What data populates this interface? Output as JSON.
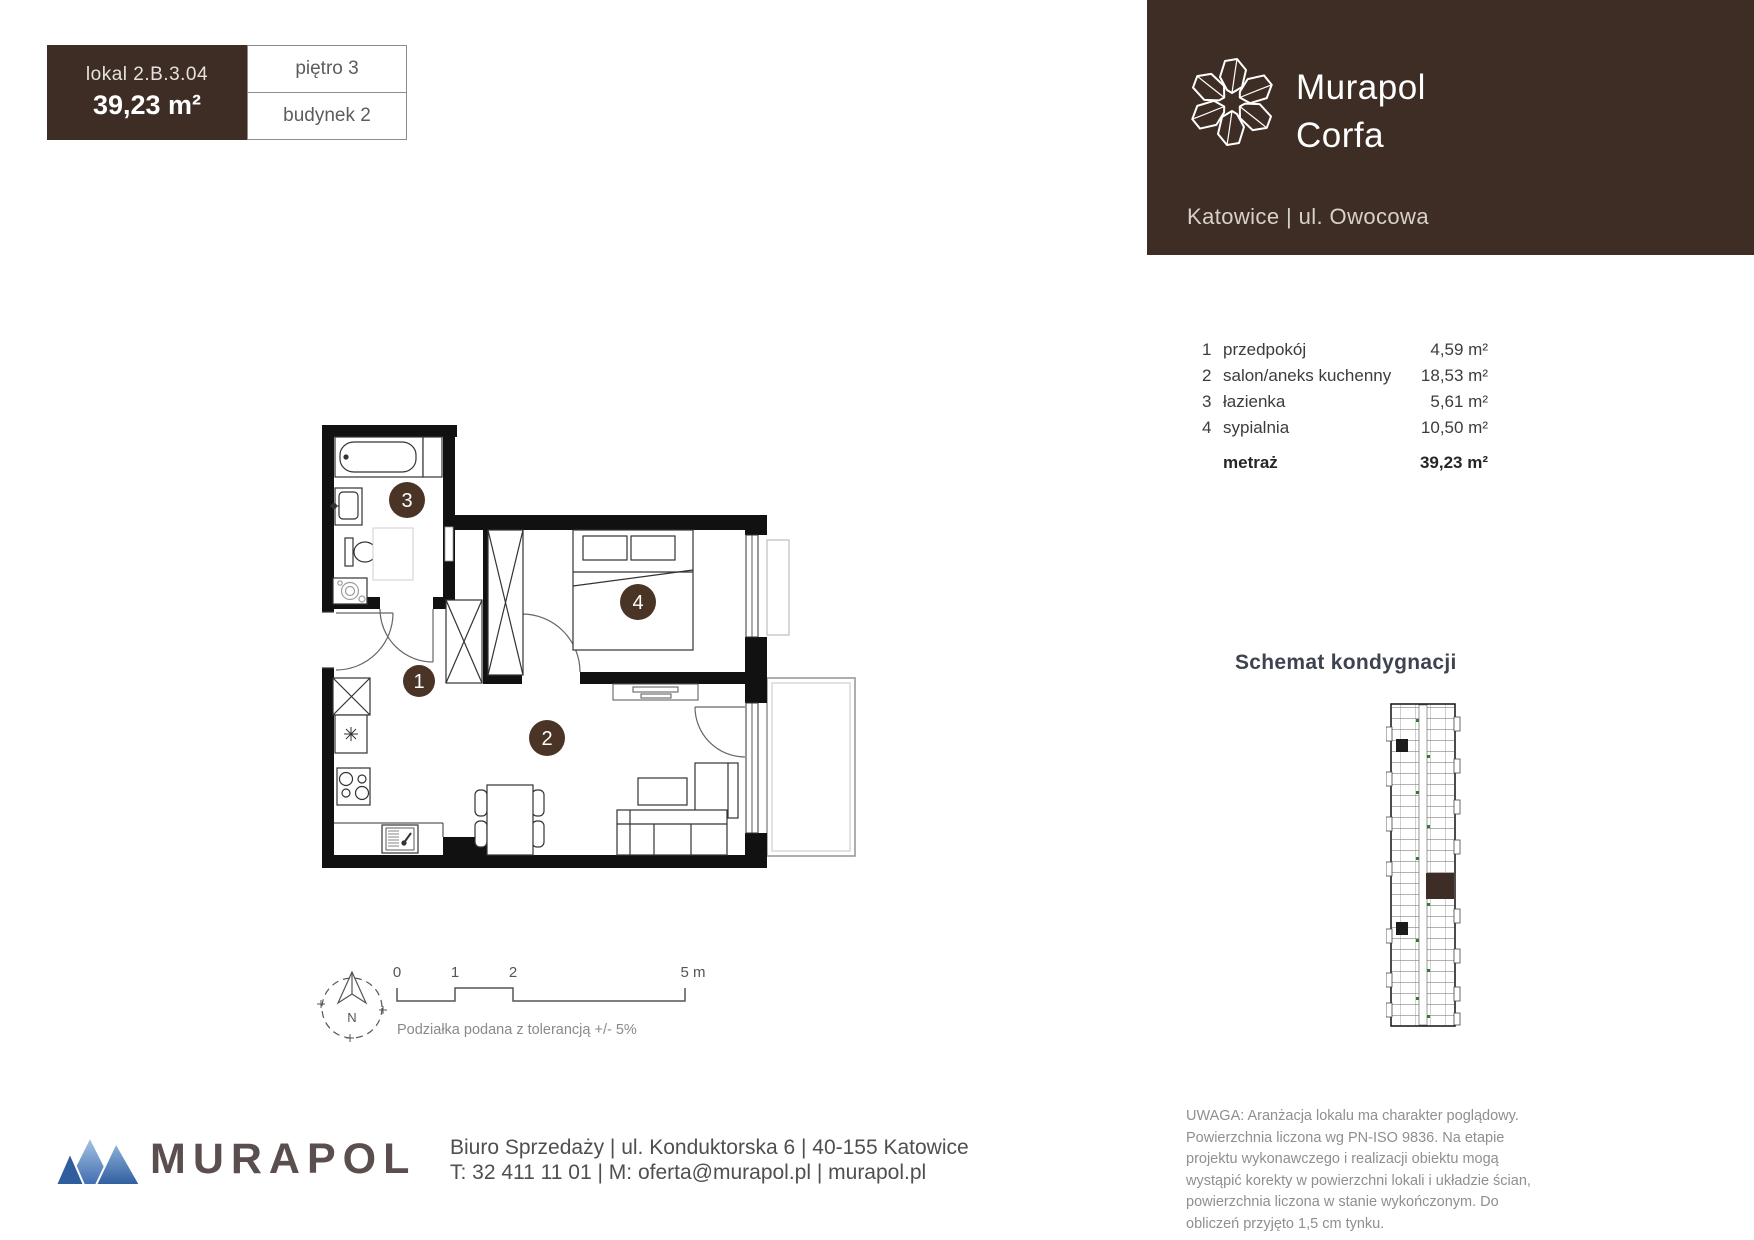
{
  "unit": {
    "lokal_label": "lokal  2.B.3.04",
    "area": "39,23 m²",
    "floor": "piętro 3",
    "building": "budynek 2"
  },
  "header": {
    "project_name_line1": "Murapol",
    "project_name_line2": "Corfa",
    "location": "Katowice | ul. Owocowa"
  },
  "rooms": {
    "items": [
      {
        "no": "1",
        "name": "przedpokój",
        "area": "4,59 m²"
      },
      {
        "no": "2",
        "name": "salon/aneks kuchenny",
        "area": "18,53 m²"
      },
      {
        "no": "3",
        "name": "łazienka",
        "area": "5,61 m²"
      },
      {
        "no": "4",
        "name": "sypialnia",
        "area": "10,50 m²"
      }
    ],
    "total_label": "metraż",
    "total_area": "39,23 m²"
  },
  "plan": {
    "labels": {
      "hall": "1",
      "living": "2",
      "bath": "3",
      "bedroom": "4"
    }
  },
  "schematic": {
    "title": "Schemat kondygnacji"
  },
  "scale_bar": {
    "ticks": [
      "0",
      "1",
      "2",
      "5 m"
    ],
    "note": "Podziałka podana z tolerancją +/- 5%",
    "compass": "N"
  },
  "footer": {
    "brand": "MURAPOL",
    "address_line1": "Biuro Sprzedaży | ul. Konduktorska 6 | 40-155 Katowice",
    "address_line2": "T: 32 411 11 01 | M: oferta@murapol.pl | murapol.pl",
    "disclaimer": "UWAGA: Aranżacja lokalu ma charakter poglądowy.  Powierzchnia liczona wg PN-ISO 9836.  Na etapie projektu wykonawczego i realizacji obiektu mogą wystąpić korekty w powierzchni lokali i układzie  ścian, powierzchnia liczona w stanie wykończonym.  Do obliczeń przyjęto 1,5 cm tynku."
  },
  "colors": {
    "brand_brown": "#3d2d25",
    "circle_brown": "#4a3426",
    "door_green": "#2e7d32",
    "logo_blue_dark": "#2f5d9e",
    "logo_blue_light": "#a9c5e3",
    "text_dark": "#3c3c3c",
    "text_gray": "#8f8f8f"
  }
}
